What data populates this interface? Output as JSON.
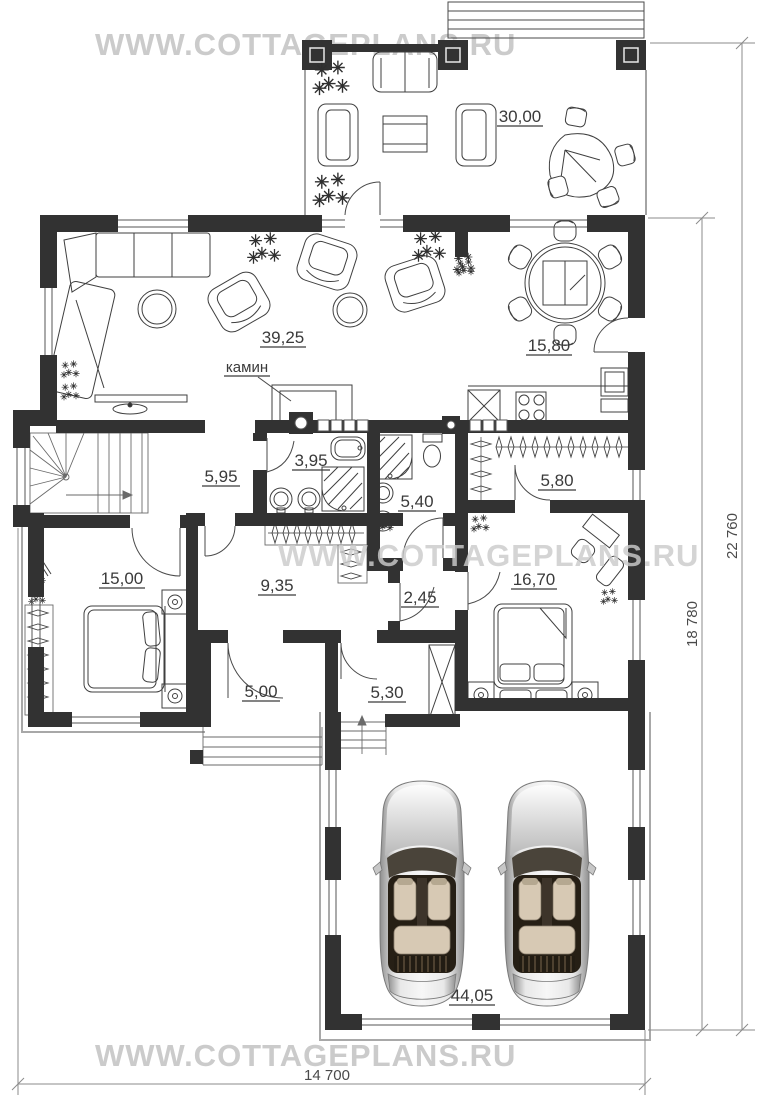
{
  "watermark": {
    "text": "WWW.COTTAGEPLANS.RU"
  },
  "plan": {
    "rooms": {
      "terrace": "30,00",
      "living_room": "39,25",
      "kitchen_dining": "15,80",
      "hall": "5,95",
      "bathroom_1": "3,95",
      "bathroom_2": "5,40",
      "wardrobe": "5,80",
      "bedroom_1": "15,00",
      "corridor": "9,35",
      "bath_lobby": "2,45",
      "bedroom_2": "16,70",
      "entry": "5,00",
      "boiler_room": "5,30",
      "garage": "44,05"
    },
    "annotations": {
      "fireplace": "камин"
    },
    "dimensions": {
      "overall_height": "22 760",
      "house_height": "18 780",
      "overall_width": "14 700"
    }
  },
  "colors": {
    "wall": "#323232",
    "watermark": "#cbcbcb",
    "dimension_text": "#4a4a4a"
  }
}
